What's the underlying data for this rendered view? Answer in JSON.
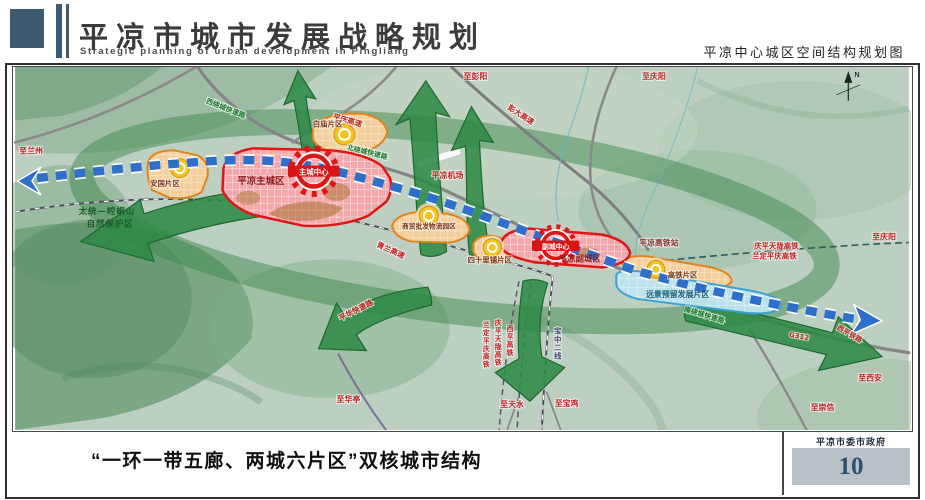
{
  "header": {
    "title": "平凉市城市发展战略规划",
    "subtitle": "Strategic planning of urban development in Pingliang",
    "map_title": "平凉中心城区空间结构规划图"
  },
  "map": {
    "compass": "N",
    "cities": {
      "main_city": "平凉主城区",
      "main_center": "主城中心",
      "sub_city": "平凉副城区",
      "sub_center": "副城中心"
    },
    "districts": {
      "baimiao": "白庙片区",
      "anguo": "安国片区",
      "logistics": "商贸批发物流园区",
      "sishilipu": "四十里铺片区",
      "gaotie": "高铁片区",
      "reserve": "远景预留发展片区"
    },
    "features": {
      "airport": "平凉机场",
      "hsr_station": "平凉高铁站",
      "nature_reserve_1": "太统—崆峒山",
      "nature_reserve_2": "自然保护区"
    },
    "roads": {
      "west_ring": "西绕城快速路",
      "north_ring": "北绕城快速路",
      "south_ring": "南绕城快速路",
      "pinghua": "平华快速路",
      "pingqing": "平庆高速",
      "pengda": "彭大高速",
      "qinglan": "青兰高速",
      "g312": "G312",
      "xiping": "西平铁路"
    },
    "railways": {
      "qingping_tianlong": "庆平天陇高铁",
      "landing_pingqing": "兰定平庆高铁",
      "xiping_hsr": "西平高铁",
      "baozhong": "宝中二线"
    },
    "destinations": {
      "lanzhou": "至兰州",
      "pengyang": "至彭阳",
      "qingyang_north": "至庆阳",
      "qingyang_east": "至庆阳",
      "xian": "至西安",
      "chongxin": "至崇信",
      "huating": "至华亭",
      "tianshui": "至天水",
      "baoji": "至宝鸡"
    }
  },
  "footer": {
    "caption": "“一环一带五廊、两城六片区”双核城市结构",
    "organization": "平凉市委市政府",
    "page_number": "10"
  },
  "colors": {
    "accent_slate": "#3e5a70",
    "city_red": "#e01515",
    "district_orange": "#e2831c",
    "corridor_green": "#2c8544",
    "belt_blue": "#2e6fc9",
    "reserve_blue": "#bfe6f2"
  }
}
